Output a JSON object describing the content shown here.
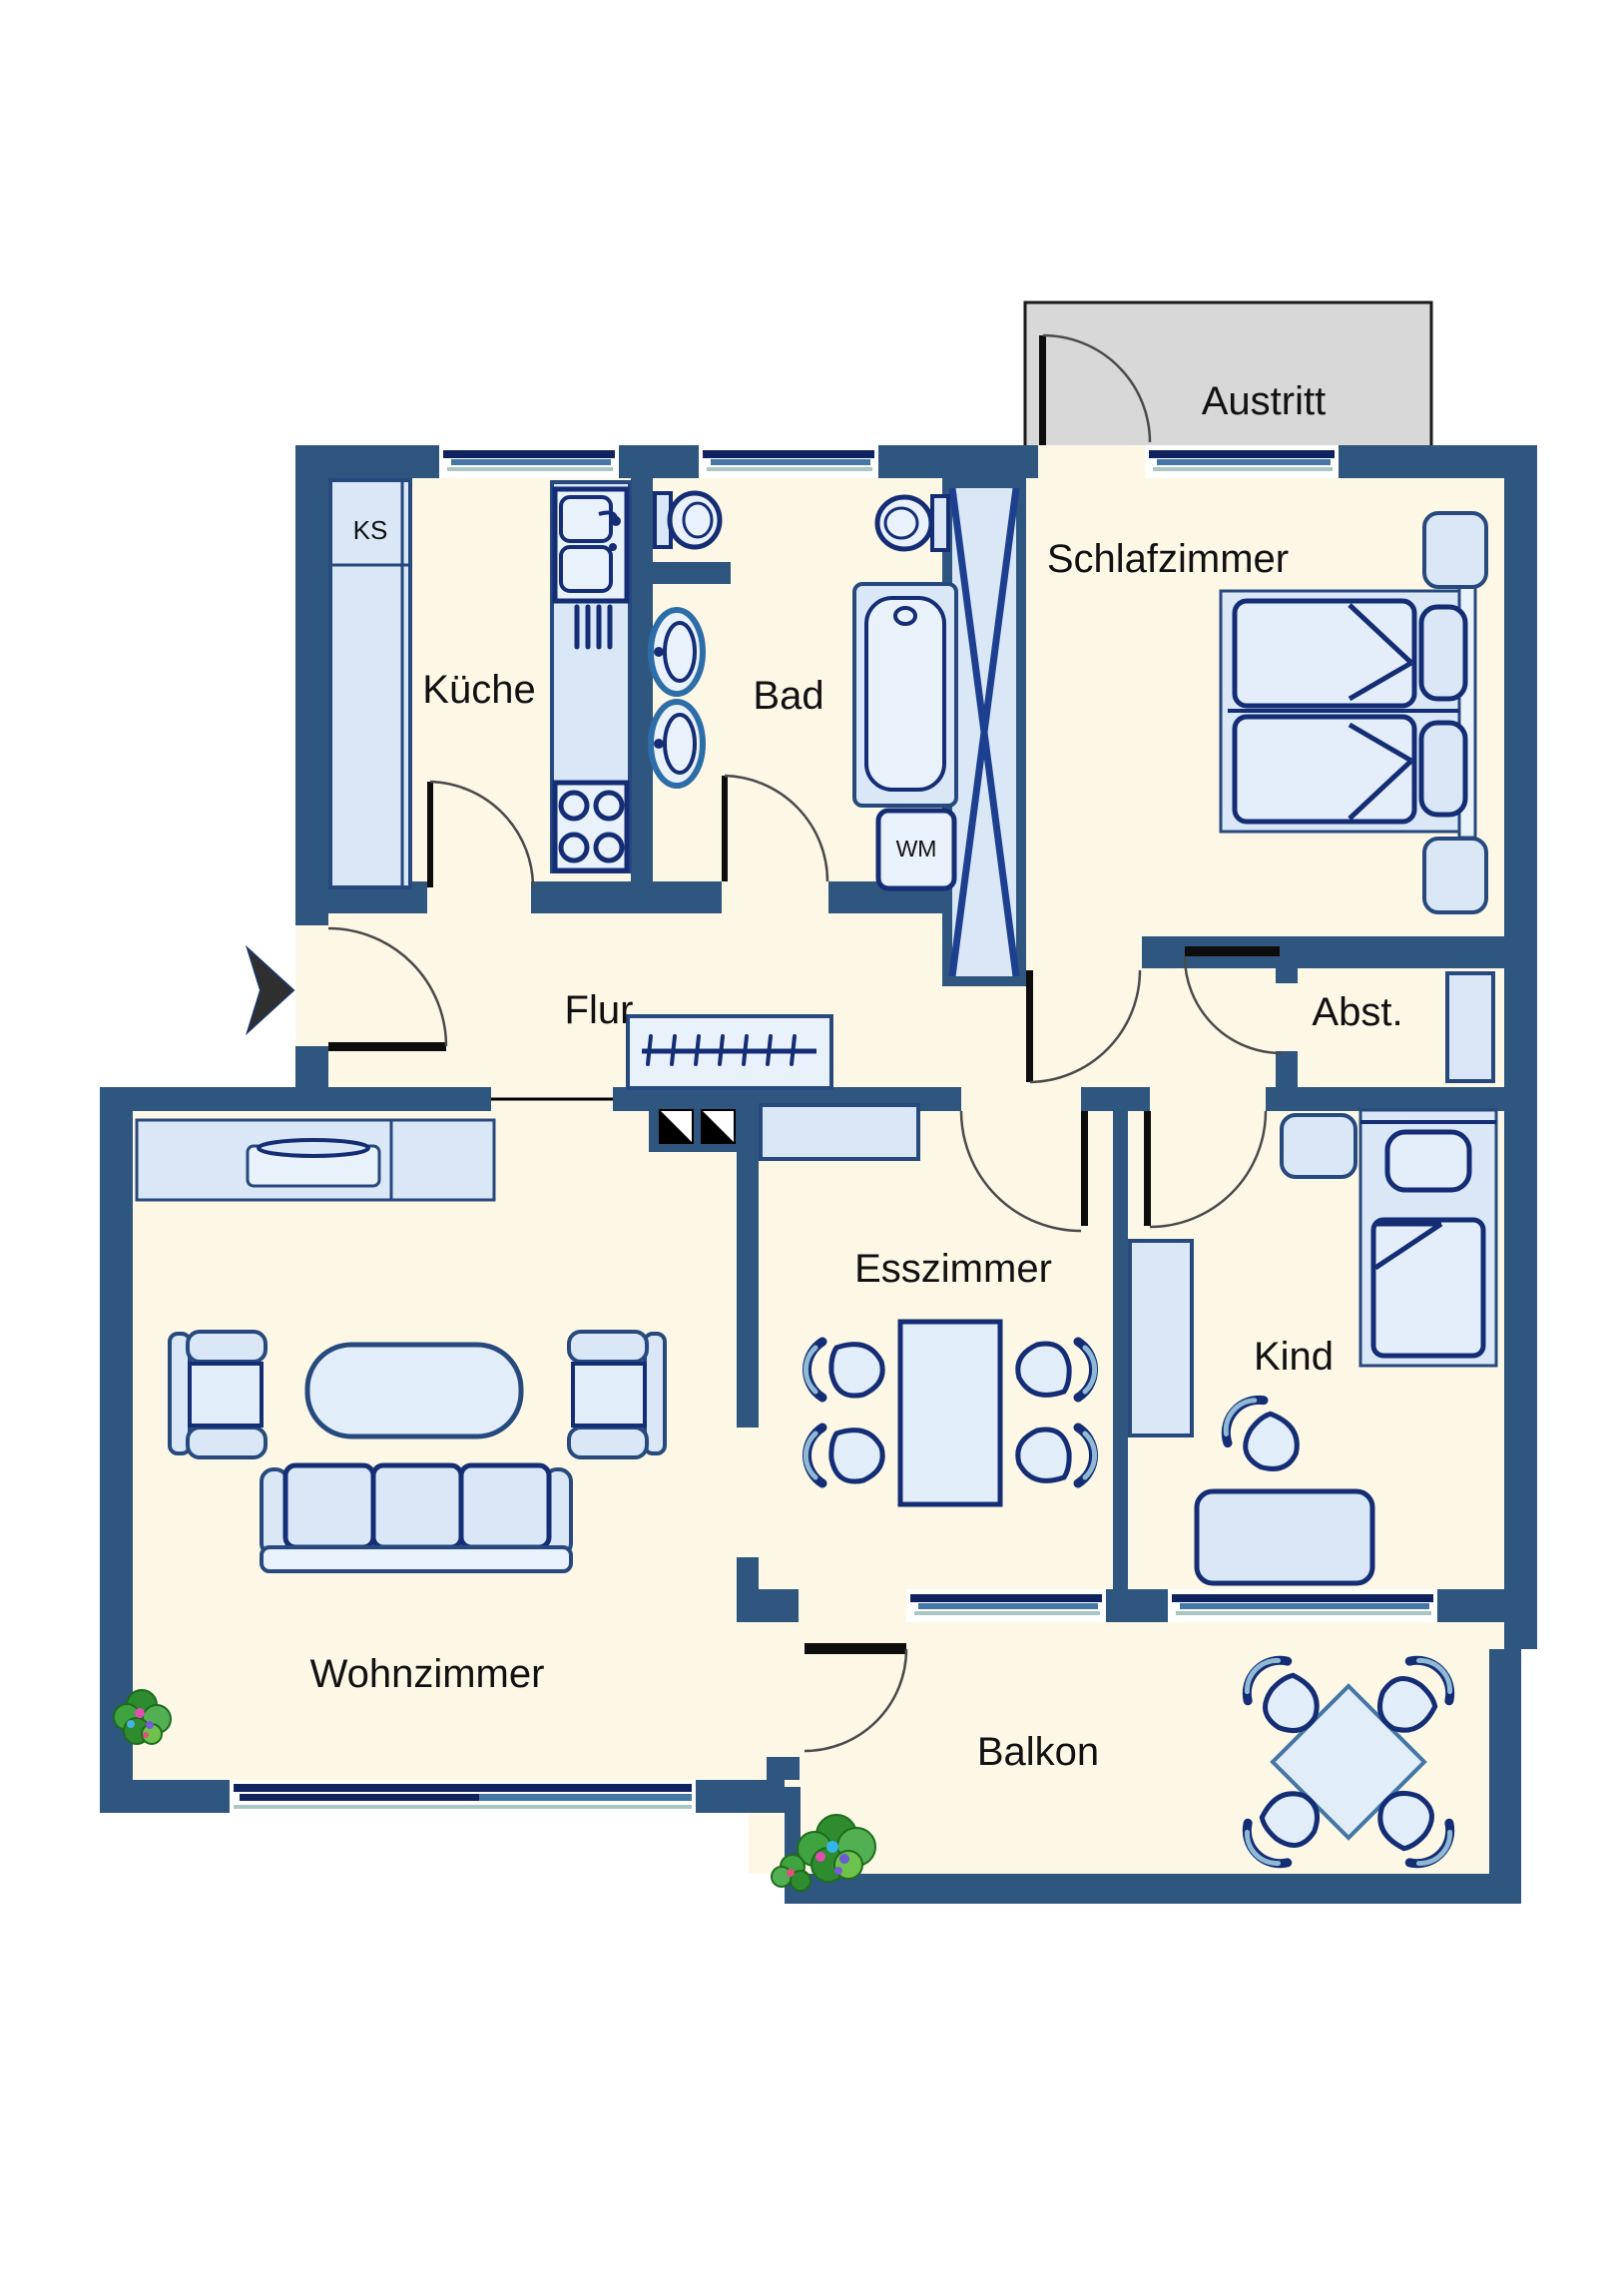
{
  "diagram_type": "apartment-floor-plan",
  "language": "de",
  "rooms": {
    "austritt": {
      "label": "Austritt"
    },
    "schlafzimmer": {
      "label": "Schlafzimmer"
    },
    "kueche": {
      "label": "Küche"
    },
    "bad": {
      "label": "Bad"
    },
    "flur": {
      "label": "Flur"
    },
    "abstellraum": {
      "label": "Abst."
    },
    "esszimmer": {
      "label": "Esszimmer"
    },
    "kind": {
      "label": "Kind"
    },
    "wohnzimmer": {
      "label": "Wohnzimmer"
    },
    "balkon": {
      "label": "Balkon"
    }
  },
  "appliances": {
    "kuehlschrank": "KS",
    "waschmaschine": "WM"
  },
  "symbols": {
    "entrance_arrow": "entrance-arrow",
    "chimney_flues": 2,
    "installation_shaft": "x-braced shaft",
    "door_count": 10
  },
  "colors": {
    "wall": "#2e567f",
    "floor": "#fdf8e5",
    "furniture_outline": "#142d74",
    "furniture_fill": "#d9e7f7",
    "furniture_fill_light": "#e9f2fb",
    "window_steel": "#4577a5",
    "window_teal": "#a9c6c3",
    "austritt_gray": "#d8d8d8",
    "plant_green": "#3fa33f",
    "label_black": "#111111"
  }
}
